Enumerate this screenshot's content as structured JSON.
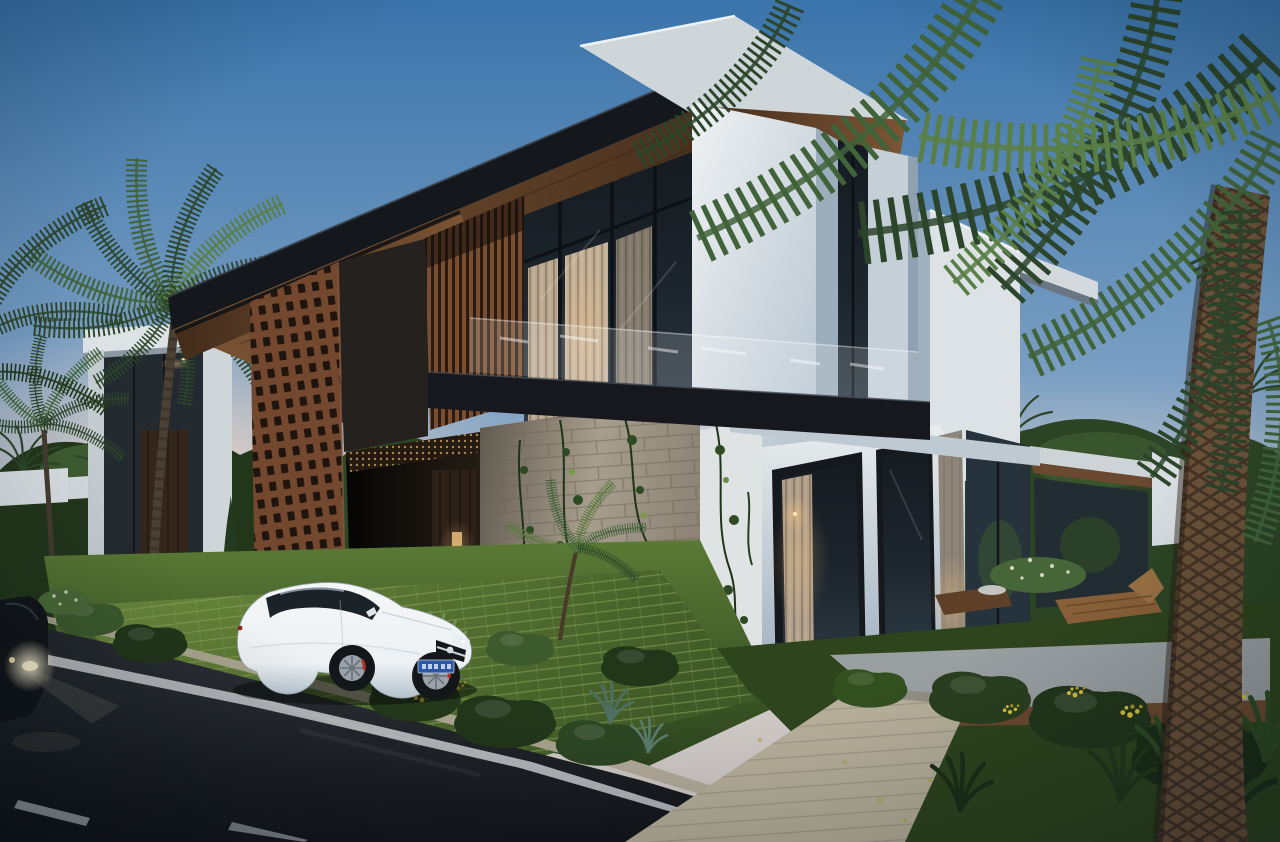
{
  "scene": {
    "type": "architectural-exterior-render",
    "time_of_day": "dusk",
    "canvas": {
      "width": 1280,
      "height": 842
    }
  },
  "palette": {
    "sky-top": "#3a74ab",
    "sky-mid": "#7b9fc3",
    "sky-low": "#b9c3cd",
    "sky-pink": "#ecd5c6",
    "roof-dark": "#14171c",
    "roof-edge": "#3a414a",
    "wood-warm": "#7c5534",
    "wood-deep": "#432c1b",
    "slat-light": "#7a4e31",
    "slat-dark": "#2a1b12",
    "brick": "#74482f",
    "brick-hole": "#1f150e",
    "white-lit": "#e9eced",
    "white-mid": "#c6d0d8",
    "white-shade": "#9cadbc",
    "glass-dark": "#1d252d",
    "glass-mid": "#2e3c46",
    "curtain": "#c9b499",
    "curtain-lit": "#e0c19c",
    "stone-light": "#a89e8e",
    "stone-dark": "#6b6257",
    "road-dark": "#101215",
    "road-mid": "#33373d",
    "line-white": "#d9dcdd",
    "grass-dark": "#33491f",
    "grass-mid": "#567733",
    "paver-green": "#5d7c35",
    "paver-line": "#93a85c",
    "walkway": "#b8b09b",
    "curb": "#b3ab99",
    "palm-dark": "#2c452a",
    "palm-mid": "#41633a",
    "palm-light": "#5a7f46",
    "trunk": "#6a5138",
    "trunk-dark": "#3c2d20",
    "foliage-dark": "#22361a",
    "foliage-mid": "#3c5a2c",
    "foliage-light": "#57793b",
    "deck-wood": "#8a6038",
    "car-white": "#eef1f3",
    "car-shade": "#b4c2cd",
    "plate-blue": "#2a57a8",
    "glow-warm": "#f3c27e",
    "flower-yellow": "#d8c23e",
    "headlight": "#fff3d2"
  },
  "objects": {
    "architecture": [
      "main-villa",
      "neighbor-house",
      "brick-lattice-screen",
      "wood-slat-screen",
      "stone-feature-wall",
      "glass-balcony-railing",
      "white-tower-volume",
      "rear-garden-canopy"
    ],
    "vehicles": [
      "white-coupe",
      "dark-car-headlights"
    ],
    "landscape": [
      "left-palm-trees",
      "right-foreground-palm",
      "cypress-trees",
      "garden-bushes",
      "yellow-flowers",
      "grass-paver-driveway",
      "asphalt-road",
      "stone-walkway",
      "sun-loungers"
    ]
  },
  "license_plate": {
    "color": "#2a57a8",
    "text_legible": false
  }
}
